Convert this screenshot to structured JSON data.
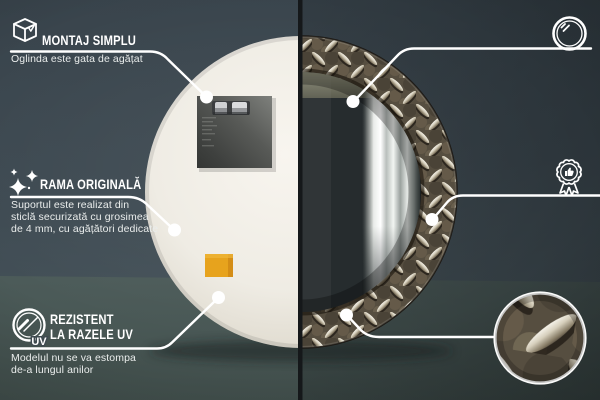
{
  "image_type": "product-feature-infographic",
  "colors": {
    "wall": "#3e4a52",
    "floor": "#576663",
    "accent": "#ffffff",
    "mirror_back": "#efece4",
    "sticker": "#e7a31d",
    "frame_base": "#564e40",
    "divider": "#15181a"
  },
  "callouts": {
    "montaj": {
      "icon": "box-icon",
      "title_lines": [
        "MONTAJ SIMPLU"
      ],
      "desc_lines": [
        "Oglinda este gata de agățat"
      ]
    },
    "rama": {
      "icon": "sparkles-icon",
      "title_lines": [
        "RAMA ORIGINALĂ"
      ],
      "desc_lines": [
        "Suportul este realizat din",
        "sticlă securizată cu grosimea",
        "de 4 mm, cu agățători dedicate"
      ]
    },
    "uv": {
      "icon": "uv-icon",
      "uv_label": "UV",
      "title_lines": [
        "REZISTENT",
        "LA RAZELE UV"
      ],
      "desc_lines": [
        "Modelul nu se va estompa",
        "de-a lungul anilor"
      ]
    },
    "oglinda": {
      "icon": "mirror-icon",
      "title_lines": [
        "OGLINDĂ DE",
        "CLASĂ SUPERIOARĂ"
      ],
      "desc_lines": [
        "O suprafață perfect netedă,",
        "care nu deformează reflexia"
      ]
    },
    "design": {
      "icon": "badge-icon",
      "title_lines": [
        "DESIGN UNIC"
      ],
      "desc_lines": [
        "Design atemporal",
        "pentru orice interior"
      ]
    }
  }
}
